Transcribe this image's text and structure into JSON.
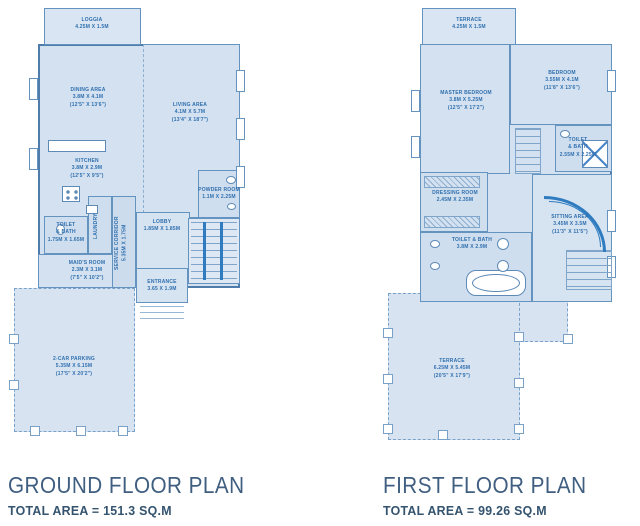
{
  "colors": {
    "room_fill": "#d3e1f0",
    "wall": "#4f7dab",
    "stair_accent": "#2e7bbf",
    "label_text": "#2f6fae",
    "title_text": "#3f5e80",
    "background": "#ffffff"
  },
  "ground_floor": {
    "title": "GROUND FLOOR PLAN",
    "total_area": "TOTAL AREA  =  151.3 SQ.M",
    "rooms": {
      "loggia": {
        "name": "LOGGIA",
        "dims": "4.25M X 1.5M"
      },
      "dining": {
        "name": "DINING AREA",
        "dims": "3.8M X 4.1M",
        "imperial": "(12'5\" X 13'6\")"
      },
      "living": {
        "name": "LIVING AREA",
        "dims": "4.1M X 5.7M",
        "imperial": "(13'4\" X 18'7\")"
      },
      "kitchen": {
        "name": "KITCHEN",
        "dims": "3.8M X 2.9M",
        "imperial": "(12'5\" X 9'5\")"
      },
      "toilet_bath": {
        "name": "TOILET",
        "name2": "& BATH",
        "dims": "1.75M X 1.65M"
      },
      "laundry": {
        "name": "LAUNDRY"
      },
      "service_corridor": {
        "name": "SERVICE CORRIDOR",
        "dims": "5.35M X 1.75M"
      },
      "maids_room": {
        "name": "MAID'S ROOM",
        "dims": "2.3M X 3.1M",
        "imperial": "(7'5\" X 10'2\")"
      },
      "lobby": {
        "name": "LOBBY",
        "dims": "1.85M X 1.85M"
      },
      "powder_room": {
        "name": "POWDER ROOM",
        "dims": "1.1M X 2.25M"
      },
      "entrance": {
        "name": "ENTRANCE",
        "dims": "3.65 X 1.9M"
      },
      "parking": {
        "name": "2-CAR PARKING",
        "dims": "5.35M X 6.15M",
        "imperial": "(17'5\" X 20'2\")"
      }
    }
  },
  "first_floor": {
    "title": "FIRST FLOOR PLAN",
    "total_area": "TOTAL AREA  =  99.26 SQ.M",
    "rooms": {
      "terrace": {
        "name": "TERRACE",
        "dims": "4.25M X 1.5M"
      },
      "master_bedroom": {
        "name": "MASTER BEDROOM",
        "dims": "3.8M X 5.25M",
        "imperial": "(12'5\" X 17'2\")"
      },
      "bedroom": {
        "name": "BEDROOM",
        "dims": "3.55M X 4.1M",
        "imperial": "(11'8\" X 13'6\")"
      },
      "toilet_bath": {
        "name": "TOILET",
        "name2": "& BATH",
        "dims": "2.55M X 2.25M"
      },
      "dressing_room": {
        "name": "DRESSING ROOM",
        "dims": "2.45M X 2.35M"
      },
      "toilet_bath_master": {
        "name": "TOILET & BATH",
        "dims": "3.8M X 2.9M"
      },
      "sitting_area": {
        "name": "SITTING AREA",
        "dims": "3.45M X 3.5M",
        "imperial": "(11'3\" X 11'5\")"
      },
      "terrace_large": {
        "name": "TERRACE",
        "dims": "6.25M X 5.45M",
        "imperial": "(20'5\" X 17'9\")"
      }
    }
  }
}
